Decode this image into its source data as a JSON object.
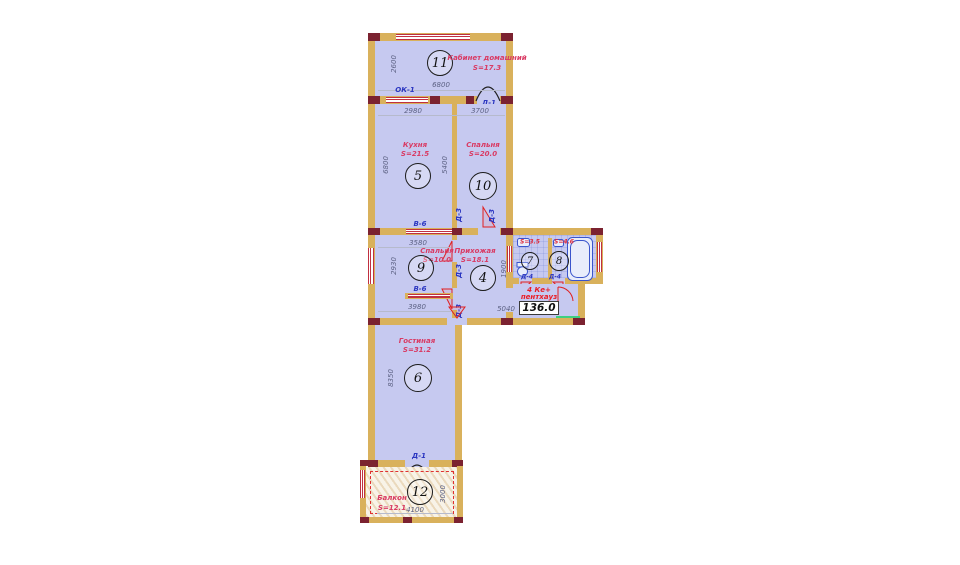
{
  "plan": {
    "badge": {
      "line1": "4 Ке+",
      "line2": "пентхауз",
      "total": "136.0"
    },
    "rooms": {
      "r11": {
        "num": "11",
        "name": "Кабинет домашний",
        "area": "S=17.3"
      },
      "r5": {
        "num": "5",
        "name": "Кухня",
        "area": "S=21.5"
      },
      "r10": {
        "num": "10",
        "name": "Спальня",
        "area": "S=20.0"
      },
      "r9": {
        "num": "9",
        "name": "Спальня",
        "area": "S=10.0"
      },
      "r4": {
        "num": "4",
        "name": "Прихожая",
        "area": "S=18.1"
      },
      "r7": {
        "num": "7",
        "area": "S=3.5"
      },
      "r8": {
        "num": "8",
        "area": "S=4.6"
      },
      "r6": {
        "num": "6",
        "name": "Гостиная",
        "area": "S=31.2"
      },
      "r12": {
        "num": "12",
        "name": "Балкон",
        "area": "S=12.1"
      }
    },
    "dims": {
      "v2600": "2600",
      "h6800": "6800",
      "h2980": "2980",
      "h3700": "3700",
      "v6800": "6800",
      "v5400": "5400",
      "h3580": "3580",
      "v2930": "2930",
      "h3980": "3980",
      "v1900": "1900",
      "h5040": "5040",
      "v8350": "8350",
      "v3000": "3000",
      "h4100": "4100"
    },
    "marks": {
      "ok1": "ОК-1",
      "d1": "Д-1",
      "d3": "Д-3",
      "v6": "В-6",
      "d4": "Д-4"
    },
    "colors": {
      "wall": "#d9b15c",
      "corner_block": "#7b2230",
      "floor": "#c6c9f0",
      "window_red": "#c03040",
      "label_red": "#d93a63",
      "mark_blue": "#2a35c0",
      "dim_gray": "#5d6284",
      "badge_red": "#ea1c24",
      "green": "#3ecf81"
    }
  }
}
